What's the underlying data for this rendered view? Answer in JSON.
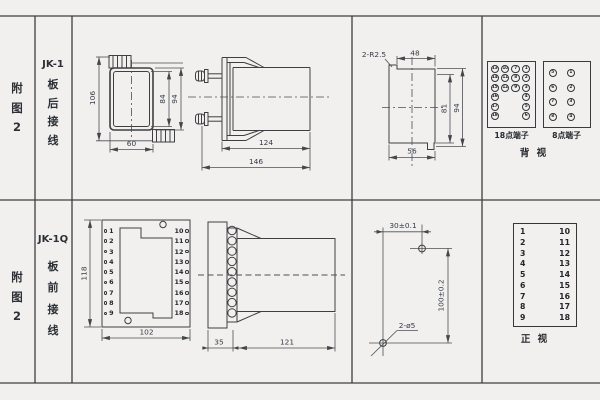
{
  "colors": {
    "background": "#f1f0ee",
    "line": "#3e3f42",
    "ink": "#2c3036"
  },
  "row1": {
    "fig": {
      "c1": "附",
      "c2": "图",
      "c3": "2"
    },
    "model": "JK-1",
    "wiring": {
      "c1": "板",
      "c2": "后",
      "c3": "接",
      "c4": "线"
    },
    "front": {
      "h_total": "106",
      "h_inner": "84",
      "h_case": "94",
      "w_case": "60"
    },
    "side": {
      "d_case": "124",
      "d_total": "146"
    },
    "cutout": {
      "note": "2-R2.5",
      "w_top": "48",
      "h_inner": "81",
      "h_outer": "94",
      "w_bottom": "56"
    },
    "t18": {
      "label": "18点端子",
      "r1": [
        "13",
        "10",
        "7",
        "1"
      ],
      "r2": [
        "14",
        "11",
        "8",
        "2"
      ],
      "r3": [
        "15",
        "12",
        "9",
        "3"
      ],
      "r4c1": "16",
      "r4c4": "4",
      "r5c1": "17",
      "r5c4": "5",
      "r6c1": "18",
      "r6c4": "6"
    },
    "t8": {
      "label": "8点端子",
      "r1": [
        "5",
        "1"
      ],
      "r2": [
        "6",
        "2"
      ],
      "r3": [
        "7",
        "3"
      ],
      "r4": [
        "8",
        "4"
      ]
    },
    "view": "背 视"
  },
  "row2": {
    "fig": {
      "c1": "附",
      "c2": "图",
      "c3": "2"
    },
    "model": "JK-1Q",
    "wiring": {
      "c1": "板",
      "c2": "前",
      "c3": "接",
      "c4": "线"
    },
    "front": {
      "h": "118",
      "w": "102",
      "left": [
        "1",
        "2",
        "3",
        "4",
        "5",
        "6",
        "7",
        "8",
        "9"
      ],
      "right": [
        "10",
        "11",
        "12",
        "13",
        "14",
        "15",
        "16",
        "17",
        "18"
      ]
    },
    "side": {
      "d_plate": "35",
      "d_body": "121"
    },
    "drill": {
      "dx": "30±0.1",
      "dy": "100±0.2",
      "note": "2-ø5"
    },
    "table": {
      "left": [
        "1",
        "2",
        "3",
        "4",
        "5",
        "6",
        "7",
        "8",
        "9"
      ],
      "right": [
        "10",
        "11",
        "12",
        "13",
        "14",
        "15",
        "16",
        "17",
        "18"
      ],
      "view": "正 视"
    }
  }
}
